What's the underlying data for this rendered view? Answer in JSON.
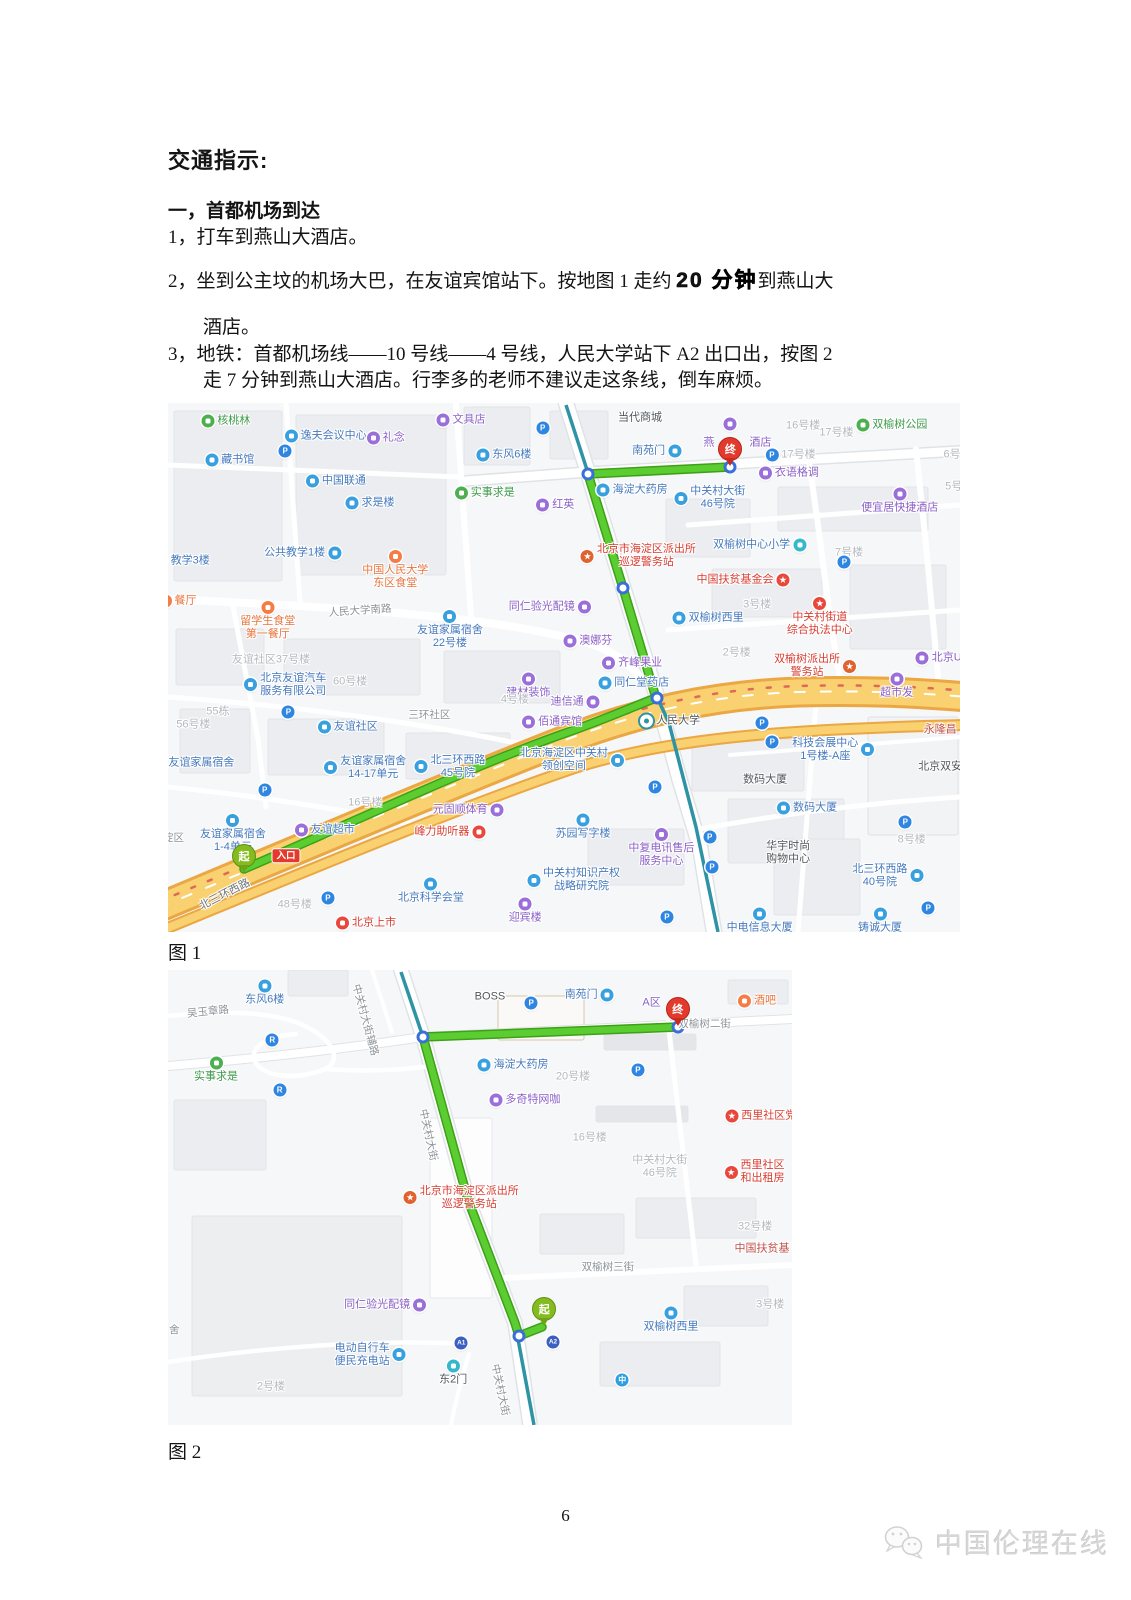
{
  "doc": {
    "title": "交通指示:",
    "section_heading": "一，首都机场到达",
    "item1_num": "1，",
    "item1_text": "打车到燕山大酒店。",
    "item2_num": "2，",
    "item2_text1": "坐到公主坟的机场大巴，在友谊宾馆站下。按地图 1 走约 ",
    "item2_bold": "20 分钟",
    "item2_text2": "到燕山大",
    "item2_line2": "酒店。",
    "item3_num": "3，",
    "item3_line1": "地铁：首都机场线——10 号线——4 号线，人民大学站下 A2 出口出，按图 2",
    "item3_line2": "走 7 分钟到燕山大酒店。行李多的老师不建议走这条线，倒车麻烦。",
    "figure1_caption": "图 1",
    "figure2_caption": "图 2",
    "page_number": "6",
    "watermark_text": "中国伦理在线"
  },
  "colors": {
    "route_green": "#5bcd31",
    "highway_yellow": "#f9d170",
    "subway_teal": "#2e93a4",
    "start_pin": "#84bb1f",
    "end_pin": "#e23b2e",
    "poi_blue": "#38a0df",
    "poi_purple": "#9a6fd8",
    "poi_red": "#e8473c"
  },
  "map1": {
    "pins": [
      {
        "label": "起",
        "kind": "start",
        "x": 9.6,
        "y": 88.8
      },
      {
        "label": "终",
        "kind": "end",
        "x": 71.0,
        "y": 11.9
      }
    ],
    "tags": [
      {
        "label": "入口",
        "x": 14.9,
        "y": 85.6
      }
    ],
    "pois": [
      {
        "t": "核桃林",
        "c": "g",
        "x": 7.3,
        "y": 3.4
      },
      {
        "t": "逸夫会议中心",
        "c": "b",
        "x": 19.9,
        "y": 6.2
      },
      {
        "t": "礼念",
        "c": "p",
        "x": 27.5,
        "y": 6.6
      },
      {
        "t": "文具店",
        "c": "p",
        "x": 37.0,
        "y": 3.2
      },
      {
        "t": "东风6楼",
        "c": "b",
        "x": 42.4,
        "y": 9.8
      },
      {
        "t": "藏书馆",
        "c": "b",
        "x": 7.8,
        "y": 10.8
      },
      {
        "t": "",
        "c": "P",
        "g": "P",
        "x": 14.8,
        "y": 9.1
      },
      {
        "t": "",
        "c": "P",
        "g": "P",
        "x": 47.3,
        "y": 4.7
      },
      {
        "t": "中国联通",
        "c": "b",
        "x": 21.2,
        "y": 14.7
      },
      {
        "t": "求是楼",
        "c": "b",
        "x": 25.5,
        "y": 18.9
      },
      {
        "t": "实事求是",
        "c": "g",
        "x": 40.0,
        "y": 17.0
      },
      {
        "t": "红英",
        "c": "p",
        "x": 48.9,
        "y": 19.3
      },
      {
        "t": "公共教学1楼",
        "c": "b",
        "d": "r",
        "x": 17.0,
        "y": 28.4
      },
      {
        "t": "教学3楼",
        "c": "b",
        "x": 1.8,
        "y": 29.9
      },
      {
        "t": "中国人民大学\n东区食堂",
        "c": "o",
        "d": "t",
        "x": 28.7,
        "y": 31.6
      },
      {
        "t": "餐厅",
        "c": "o",
        "x": 1.2,
        "y": 37.4
      },
      {
        "t": "留学生食堂\n第一餐厅",
        "c": "o",
        "d": "t",
        "x": 12.6,
        "y": 41.3
      },
      {
        "t": "人民大学南路",
        "c": "road",
        "r": -4,
        "x": 24.2,
        "y": 39.3
      },
      {
        "t": "友谊家属宿舍\n22号楼",
        "c": "b",
        "d": "t",
        "x": 35.6,
        "y": 43.0
      },
      {
        "t": "同仁验光配镜",
        "c": "p",
        "d": "r",
        "x": 48.2,
        "y": 38.6
      },
      {
        "t": "当代商城",
        "c": "dark",
        "x": 59.6,
        "y": 2.8
      },
      {
        "t": "南苑门",
        "c": "b",
        "d": "r",
        "x": 61.7,
        "y": 9.1
      },
      {
        "t": "燕",
        "c": "pt",
        "x": 68.3,
        "y": 7.6
      },
      {
        "t": "酒店",
        "c": "pt",
        "x": 74.8,
        "y": 7.6
      },
      {
        "t": "",
        "c": "p",
        "x": 71.0,
        "y": 3.9
      },
      {
        "t": "16号楼",
        "c": "gray",
        "x": 80.2,
        "y": 4.3
      },
      {
        "t": "17号楼",
        "c": "gray",
        "x": 84.4,
        "y": 5.7
      },
      {
        "t": "双榆树公园",
        "c": "g",
        "x": 91.4,
        "y": 4.2
      },
      {
        "t": "17号楼",
        "c": "P",
        "g": "P",
        "x": 78.6,
        "y": 9.8
      },
      {
        "t": "衣语格调",
        "c": "p",
        "x": 78.4,
        "y": 13.2
      },
      {
        "t": "海淀大药房",
        "c": "b",
        "x": 58.6,
        "y": 16.4
      },
      {
        "t": "中关村大街\n46号院",
        "c": "b",
        "x": 68.4,
        "y": 18.0
      },
      {
        "t": "便宜居快捷酒店",
        "c": "p",
        "d": "t",
        "x": 92.4,
        "y": 18.5
      },
      {
        "t": "6号",
        "c": "gray",
        "x": 99.0,
        "y": 9.8
      },
      {
        "t": "5号",
        "c": "gray",
        "x": 99.2,
        "y": 15.8
      },
      {
        "t": "双榆树中心小学",
        "c": "b",
        "d": "r",
        "ic": "t",
        "x": 74.7,
        "y": 26.8
      },
      {
        "t": "7号楼",
        "c": "gray",
        "x": 86.0,
        "y": 28.4
      },
      {
        "t": "",
        "c": "P",
        "g": "P",
        "x": 85.4,
        "y": 30.1
      },
      {
        "t": "北京市海淀区派出所\n巡逻警务站",
        "c": "r",
        "ic": "pol",
        "g": "★",
        "x": 59.4,
        "y": 29.0
      },
      {
        "t": "中国扶贫基金会",
        "c": "r",
        "d": "r",
        "ic": "star",
        "g": "★",
        "x": 72.6,
        "y": 33.5
      },
      {
        "t": "中关村街道\n综合执法中心",
        "c": "r",
        "d": "t",
        "ic": "star",
        "g": "★",
        "x": 82.3,
        "y": 40.5
      },
      {
        "t": "3号楼",
        "c": "gray",
        "x": 74.4,
        "y": 38.2
      },
      {
        "t": "双榆树西里",
        "c": "b",
        "x": 68.2,
        "y": 40.6
      },
      {
        "t": "2号楼",
        "c": "gray",
        "x": 71.8,
        "y": 47.3
      },
      {
        "t": "双榆树派出所\n警务站",
        "c": "r",
        "d": "r",
        "ic": "pol",
        "g": "★",
        "x": 81.7,
        "y": 49.8
      },
      {
        "t": "超市发",
        "c": "p",
        "d": "t",
        "x": 92.0,
        "y": 53.5
      },
      {
        "t": "北京UM",
        "c": "p",
        "x": 97.9,
        "y": 48.2
      },
      {
        "t": "永隆昌",
        "c": "rt",
        "x": 97.5,
        "y": 61.8
      },
      {
        "t": "北京双安",
        "c": "dark",
        "x": 97.5,
        "y": 68.8
      },
      {
        "t": "科技会展中心\n1号楼-A座",
        "c": "b",
        "d": "r",
        "x": 84.0,
        "y": 65.6
      },
      {
        "t": "数码大厦",
        "c": "dark",
        "x": 75.4,
        "y": 71.3
      },
      {
        "t": "数码大厦",
        "c": "b",
        "x": 80.7,
        "y": 76.6
      },
      {
        "t": "苏园写字楼",
        "c": "b",
        "d": "t",
        "x": 52.4,
        "y": 80.2
      },
      {
        "t": "中复电讯售后\n服务中心",
        "c": "p",
        "d": "t",
        "x": 62.3,
        "y": 84.2
      },
      {
        "t": "中关村知识产权\n战略研究院",
        "c": "b",
        "x": 51.2,
        "y": 90.2
      },
      {
        "t": "华宇时尚\n购物中心",
        "c": "dark",
        "x": 78.3,
        "y": 85.1
      },
      {
        "t": "8号楼",
        "c": "gray",
        "x": 93.9,
        "y": 82.6
      },
      {
        "t": "北三环西路\n40号院",
        "c": "b",
        "d": "r",
        "x": 90.9,
        "y": 89.4
      },
      {
        "t": "铸诚大厦",
        "c": "b",
        "d": "t",
        "x": 89.9,
        "y": 97.9
      },
      {
        "t": "中电信息大厦",
        "c": "b",
        "d": "t",
        "x": 74.7,
        "y": 97.9
      },
      {
        "t": "友谊社区37号楼",
        "c": "gray",
        "x": 13.0,
        "y": 48.6
      },
      {
        "t": "北京友谊汽车\n服务有限公司",
        "c": "b",
        "x": 14.8,
        "y": 53.3
      },
      {
        "t": "60号楼",
        "c": "gray",
        "x": 23.0,
        "y": 52.7
      },
      {
        "t": "55栋",
        "c": "gray",
        "x": 6.3,
        "y": 58.4
      },
      {
        "t": "56号楼",
        "c": "gray",
        "x": 3.2,
        "y": 60.9
      },
      {
        "t": "",
        "c": "P",
        "g": "P",
        "x": 15.2,
        "y": 58.4
      },
      {
        "t": "三环社区",
        "c": "road",
        "x": 33.0,
        "y": 59.0
      },
      {
        "t": "建材装饰",
        "c": "p",
        "d": "t",
        "x": 45.5,
        "y": 53.5
      },
      {
        "t": "4号楼",
        "c": "gray",
        "x": 43.8,
        "y": 56.1
      },
      {
        "t": "友谊社区",
        "c": "b",
        "x": 22.7,
        "y": 61.2
      },
      {
        "t": "佰通宾馆",
        "c": "p",
        "x": 48.5,
        "y": 60.3
      },
      {
        "t": "友谊家属宿舍",
        "c": "b",
        "x": 3.2,
        "y": 68.1
      },
      {
        "t": "友谊家属宿舍\n14-17单元",
        "c": "b",
        "x": 24.9,
        "y": 69.0
      },
      {
        "t": "北三环西路\n45号院",
        "c": "b",
        "x": 35.6,
        "y": 68.8
      },
      {
        "t": "北京海淀区中关村\n领创空间",
        "c": "b",
        "d": "r",
        "x": 51.0,
        "y": 67.5
      },
      {
        "t": "16号楼",
        "c": "gray",
        "x": 24.9,
        "y": 75.6
      },
      {
        "t": "",
        "c": "P",
        "g": "P",
        "x": 12.2,
        "y": 73.2
      },
      {
        "t": "元固顺体育",
        "c": "p",
        "d": "r",
        "x": 37.9,
        "y": 76.9
      },
      {
        "t": "峰力助听器",
        "c": "r",
        "d": "r",
        "x": 35.6,
        "y": 81.1
      },
      {
        "t": "友谊超市",
        "c": "b",
        "ic": "p",
        "x": 19.8,
        "y": 80.7
      },
      {
        "t": "友谊家属宿舍\n1-4单元",
        "c": "b",
        "d": "t",
        "x": 8.2,
        "y": 81.4
      },
      {
        "t": "淀区",
        "c": "road",
        "x": 0.7,
        "y": 82.2
      },
      {
        "t": "北三环西路",
        "c": "roadDark",
        "r": -27,
        "x": 7.2,
        "y": 93.0
      },
      {
        "t": "48号楼",
        "c": "gray",
        "x": 16.0,
        "y": 94.9
      },
      {
        "t": "",
        "c": "P",
        "g": "P",
        "x": 20.2,
        "y": 93.6
      },
      {
        "t": "北京科学会堂",
        "c": "b",
        "d": "t",
        "x": 33.2,
        "y": 92.2
      },
      {
        "t": "北京上市",
        "c": "r",
        "x": 25.0,
        "y": 98.3
      },
      {
        "t": "迎宾楼",
        "c": "p",
        "d": "t",
        "x": 45.1,
        "y": 96.0
      },
      {
        "t": "澳娜芬",
        "c": "p",
        "x": 53.0,
        "y": 45.0
      },
      {
        "t": "齐峰果业",
        "c": "p",
        "x": 58.6,
        "y": 49.1
      },
      {
        "t": "同仁堂药店",
        "c": "b",
        "x": 58.8,
        "y": 52.9
      },
      {
        "t": "迪信通",
        "c": "p",
        "d": "r",
        "x": 51.4,
        "y": 56.5
      },
      {
        "t": "人民大学",
        "c": "m",
        "x": 63.4,
        "y": 60.2
      },
      {
        "t": "",
        "c": "P",
        "g": "P",
        "x": 75.0,
        "y": 60.5
      },
      {
        "t": "",
        "c": "P",
        "g": "P",
        "x": 76.3,
        "y": 64.1
      },
      {
        "t": "",
        "c": "P",
        "g": "P",
        "x": 61.5,
        "y": 72.6
      },
      {
        "t": "",
        "c": "P",
        "g": "P",
        "x": 68.4,
        "y": 82.0
      },
      {
        "t": "",
        "c": "P",
        "g": "P",
        "x": 68.7,
        "y": 87.7
      },
      {
        "t": "",
        "c": "P",
        "g": "P",
        "x": 63.0,
        "y": 97.2
      },
      {
        "t": "",
        "c": "P",
        "g": "P",
        "x": 93.1,
        "y": 79.2
      },
      {
        "t": "",
        "c": "P",
        "g": "P",
        "x": 96.0,
        "y": 95.5
      }
    ]
  },
  "map2": {
    "pins": [
      {
        "label": "起",
        "kind": "start",
        "x": 60.3,
        "y": 78.2
      },
      {
        "label": "终",
        "kind": "end",
        "x": 81.7,
        "y": 12.3
      }
    ],
    "tags": [],
    "pois": [
      {
        "t": "东风6楼",
        "c": "b",
        "d": "t",
        "x": 15.5,
        "y": 5.0
      },
      {
        "t": "吴玉章路",
        "c": "road",
        "r": -6,
        "x": 6.4,
        "y": 9.2
      },
      {
        "t": "BOSS",
        "c": "dark",
        "x": 51.6,
        "y": 5.9
      },
      {
        "t": "南苑门",
        "c": "b",
        "d": "r",
        "x": 67.5,
        "y": 5.5
      },
      {
        "t": "",
        "c": "P",
        "g": "P",
        "x": 58.2,
        "y": 7.3
      },
      {
        "t": "实事求是",
        "c": "g",
        "d": "t",
        "x": 7.7,
        "y": 22.0
      },
      {
        "t": "",
        "c": "bike",
        "g": "R",
        "x": 16.7,
        "y": 15.4
      },
      {
        "t": "",
        "c": "bike",
        "g": "R",
        "x": 17.9,
        "y": 26.4
      },
      {
        "t": "中关村大街辅路",
        "c": "road",
        "r": 75,
        "x": 31.6,
        "y": 11.0
      },
      {
        "t": "海淀大药房",
        "c": "b",
        "x": 55.3,
        "y": 20.9
      },
      {
        "t": "20号楼",
        "c": "gray",
        "x": 64.9,
        "y": 23.5
      },
      {
        "t": "多奇特网咖",
        "c": "p",
        "x": 57.2,
        "y": 28.6
      },
      {
        "t": "16号楼",
        "c": "gray",
        "x": 67.6,
        "y": 36.9
      },
      {
        "t": "中关村大街",
        "c": "road",
        "r": 78,
        "x": 41.7,
        "y": 36.3
      },
      {
        "t": "北京市海淀区派出所\n巡逻警务站",
        "c": "r",
        "ic": "pol",
        "g": "★",
        "x": 47.0,
        "y": 50.1
      },
      {
        "t": "同仁验光配镜",
        "c": "p",
        "d": "r",
        "x": 34.8,
        "y": 73.6
      },
      {
        "t": "舍",
        "c": "road",
        "x": 1.0,
        "y": 79.1
      },
      {
        "t": "电动自行车\n便民充电站",
        "c": "b",
        "d": "r",
        "x": 32.4,
        "y": 84.6
      },
      {
        "t": "2号楼",
        "c": "gray",
        "x": 16.5,
        "y": 91.6
      },
      {
        "t": "东2门",
        "c": "tt",
        "d": "t",
        "x": 45.7,
        "y": 88.6
      },
      {
        "t": "",
        "c": "a",
        "g": "A1",
        "x": 47.0,
        "y": 82.0
      },
      {
        "t": "",
        "c": "a",
        "g": "A2",
        "x": 61.7,
        "y": 81.8
      },
      {
        "t": "中关村大街",
        "c": "road",
        "r": 78,
        "x": 53.2,
        "y": 92.3
      },
      {
        "t": "双榆树三街",
        "c": "road",
        "x": 70.5,
        "y": 65.3
      },
      {
        "t": "中关村大街\n46号院",
        "c": "gray",
        "x": 78.8,
        "y": 43.3
      },
      {
        "t": "西里社区党",
        "c": "r",
        "ic": "star",
        "g": "★",
        "x": 95.0,
        "y": 32.0
      },
      {
        "t": "西里社区\n和出租房",
        "c": "r",
        "ic": "star",
        "g": "★",
        "x": 94.0,
        "y": 44.5
      },
      {
        "t": "32号楼",
        "c": "gray",
        "x": 94.1,
        "y": 56.5
      },
      {
        "t": "中国扶贫基",
        "c": "rt",
        "x": 95.2,
        "y": 61.3
      },
      {
        "t": "3号楼",
        "c": "gray",
        "x": 96.5,
        "y": 73.6
      },
      {
        "t": "双榆树西里",
        "c": "b",
        "d": "t",
        "x": 80.6,
        "y": 77.0
      },
      {
        "t": "",
        "c": "mt",
        "g": "中",
        "x": 72.8,
        "y": 90.1
      },
      {
        "t": "酒吧",
        "c": "o",
        "x": 94.4,
        "y": 6.8
      },
      {
        "t": "A区",
        "c": "pt",
        "x": 77.5,
        "y": 7.3
      },
      {
        "t": "双榆树二街",
        "c": "road",
        "x": 86.0,
        "y": 11.8
      },
      {
        "t": "",
        "c": "P",
        "g": "P",
        "x": 75.3,
        "y": 22.0
      }
    ]
  }
}
